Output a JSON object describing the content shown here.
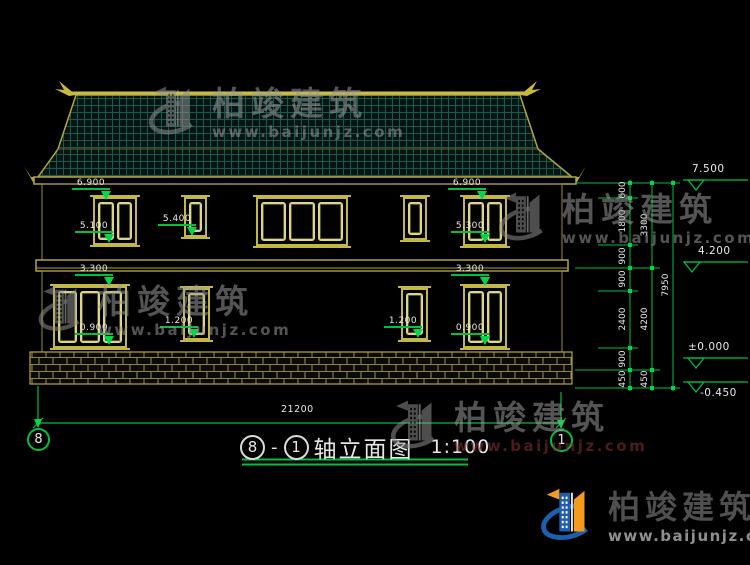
{
  "page": {
    "background": "#000000"
  },
  "colors": {
    "cad_yellow": "#c3b74a",
    "cad_green": "#00c040",
    "text_white": "#e8e8e8",
    "roof_grid_teal": "#19594f",
    "logo_blue": "#1d5fae",
    "logo_orange": "#f29b1d",
    "watermark_gray": "#909090",
    "watermark_red": "#8a3232"
  },
  "watermark": {
    "brand": "柏竣建筑",
    "url": "www.baijunjz.com"
  },
  "logo": {
    "brand": "柏竣建筑",
    "url": "www.baijunjz.com"
  },
  "title_block": {
    "axis_start": "8",
    "separator": "-",
    "axis_end": "1",
    "name": "轴立面图",
    "scale": "1:100"
  },
  "axis_bubbles": {
    "left": "8",
    "right": "1"
  },
  "dimensions": {
    "overall_width": "21200",
    "facade_labels": [
      "6.900",
      "5.100",
      "5.400",
      "3.300",
      "0.900",
      "1.200",
      "1.200",
      "6.900",
      "5.300",
      "3.300",
      "0.900"
    ],
    "right_chain_col1": [
      "600",
      "1800",
      "900",
      "900",
      "2400",
      "900",
      "450"
    ],
    "right_chain_col2": [
      "3300",
      "4200",
      "450"
    ],
    "right_chain_col3": [
      "7950"
    ],
    "elevation_markers": [
      "7.500",
      "4.200",
      "±0.000",
      "-0.450"
    ]
  }
}
